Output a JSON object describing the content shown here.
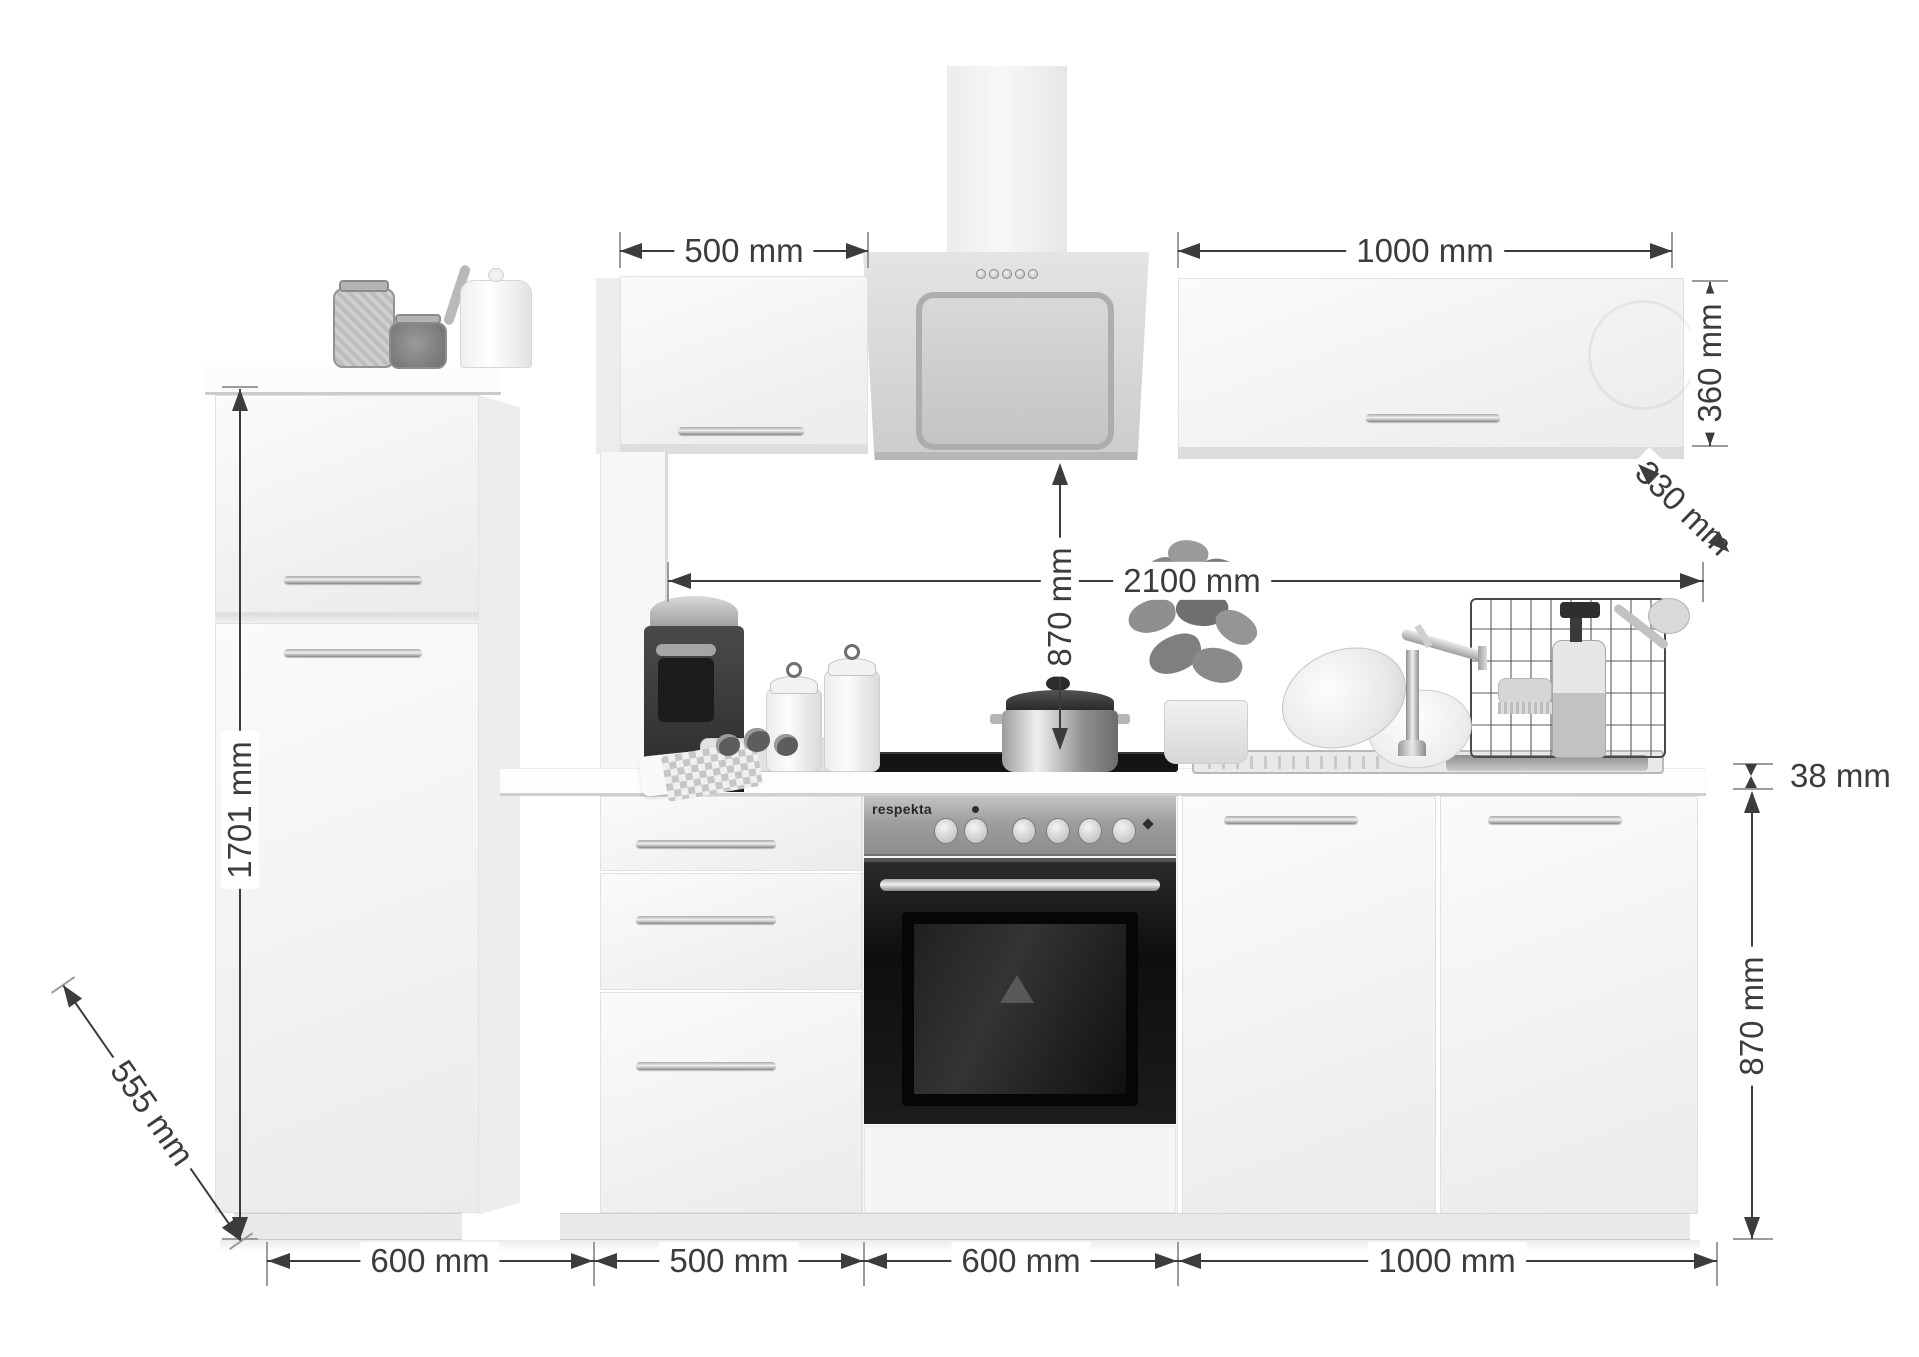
{
  "dims": {
    "wall_cab_left_width": "500 mm",
    "wall_cab_right_width": "1000 mm",
    "wall_cab_height": "360 mm",
    "wall_cab_depth": "330 mm",
    "worktop_run": "2100 mm",
    "hood_clearance": "870 mm",
    "tall_unit_height": "1701 mm",
    "worktop_depth": "555 mm",
    "worktop_thickness": "38 mm",
    "base_unit_height": "870 mm",
    "bottom_widths": [
      "600 mm",
      "500 mm",
      "600 mm",
      "1000 mm"
    ]
  },
  "brand": {
    "oven": "respekta"
  },
  "colors": {
    "dimension_line": "#3c3c3c",
    "tick": "#9b9b9b",
    "background": "#ffffff",
    "cabinet": "#f5f5f5",
    "stainless": "#a8a8a8",
    "oven_door": "#141414"
  },
  "icons": {
    "hood_buttons_count": 5,
    "oven_knobs_count": 6
  }
}
